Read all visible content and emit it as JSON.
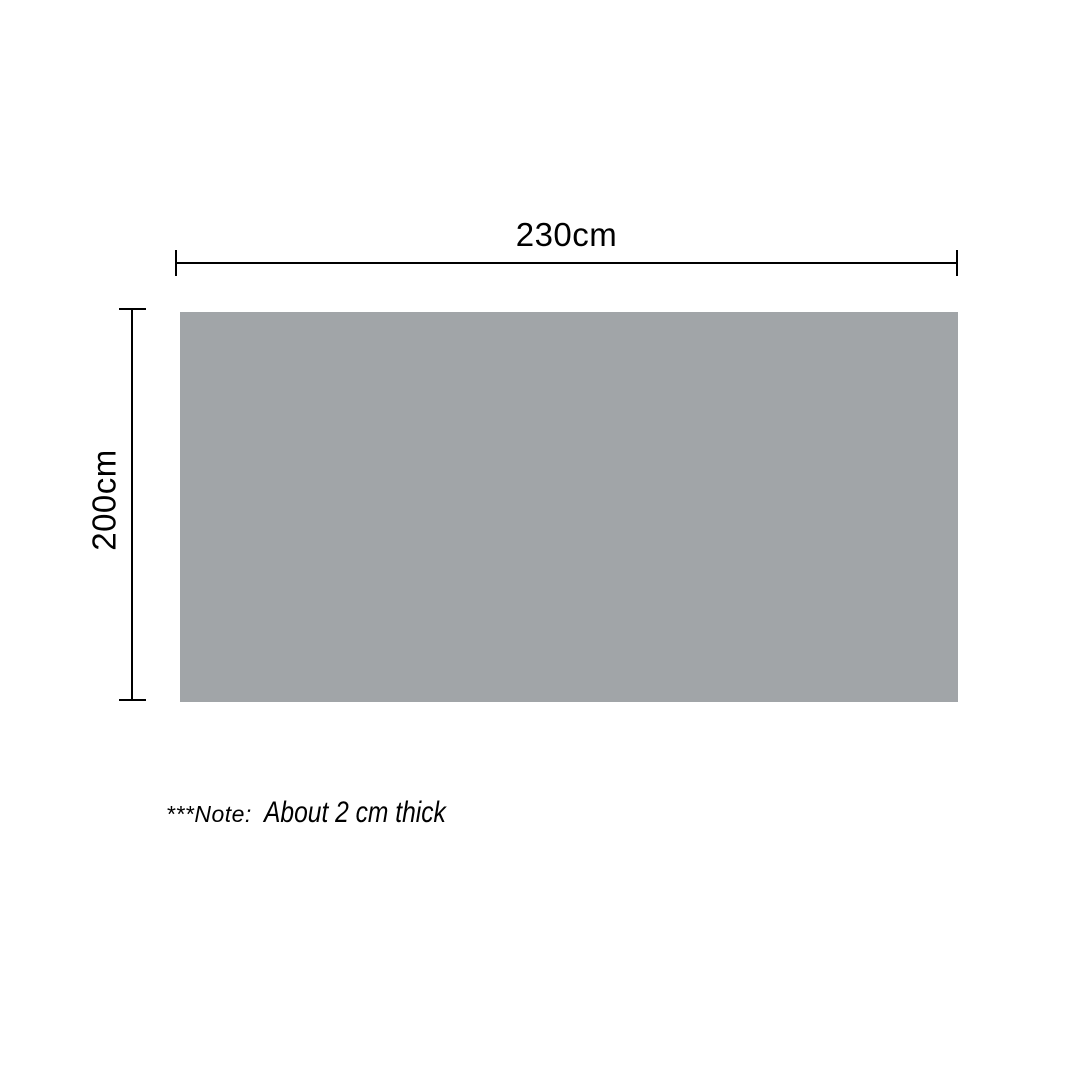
{
  "diagram": {
    "type": "product-dimension-diagram",
    "width_label": "230cm",
    "height_label": "200cm",
    "width_value_cm": 230,
    "height_value_cm": 200,
    "thickness_note_cm": 2
  },
  "note": {
    "prefix": "***Note:",
    "text": "About 2 cm thick"
  },
  "colors": {
    "background": "#FFFFFF",
    "line": "#000000",
    "text": "#000000",
    "product_fill": "#A1A5A8"
  }
}
